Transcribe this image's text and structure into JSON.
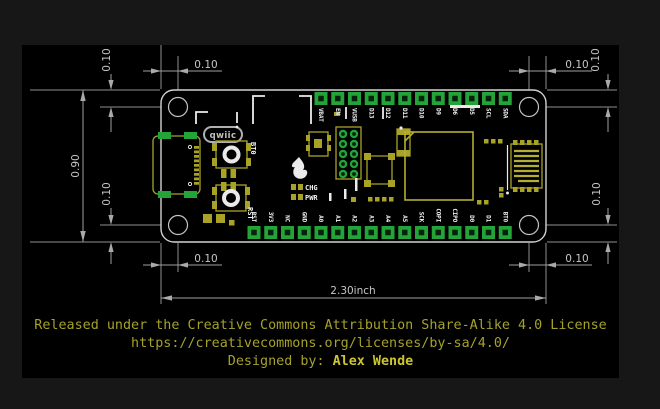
{
  "dimensions": {
    "hole_offset": "0.10",
    "board_height": "0.90",
    "board_width": "2.30inch"
  },
  "board": {
    "connector_label": "qwiic",
    "buttons": [
      {
        "label": "BT0"
      },
      {
        "label": "RST"
      }
    ],
    "leds": [
      {
        "label": "CHG"
      },
      {
        "label": "PWR"
      }
    ],
    "pins": {
      "top": [
        "VBAT",
        "EN",
        "VUSB",
        "D13",
        "D12",
        "D11",
        "D10",
        "D9",
        "D6",
        "D5",
        "SCL",
        "SDA"
      ],
      "bottom": [
        "RST",
        "3V3",
        "NC",
        "GND",
        "A0",
        "A1",
        "A2",
        "A3",
        "A4",
        "A5",
        "SCK",
        "COPI",
        "CIPO",
        "D0",
        "D1",
        "BT0"
      ]
    }
  },
  "footer": {
    "line1": "Released under the Creative Commons Attribution Share-Alike 4.0 License",
    "line2": "https://creativecommons.org/licenses/by-sa/4.0/",
    "credit_prefix": "Designed by: ",
    "credit_name": "Alex Wende"
  },
  "colors": {
    "background": "#171717",
    "panel_black": "#000000",
    "pad_green": "#23a338",
    "silk_yellow": "#a8a227",
    "silk_white": "#ebebeb",
    "dim_gray": "#9a9a9a",
    "footer_olive": "#a6a12b",
    "credit_yellow": "#ccc52e"
  }
}
